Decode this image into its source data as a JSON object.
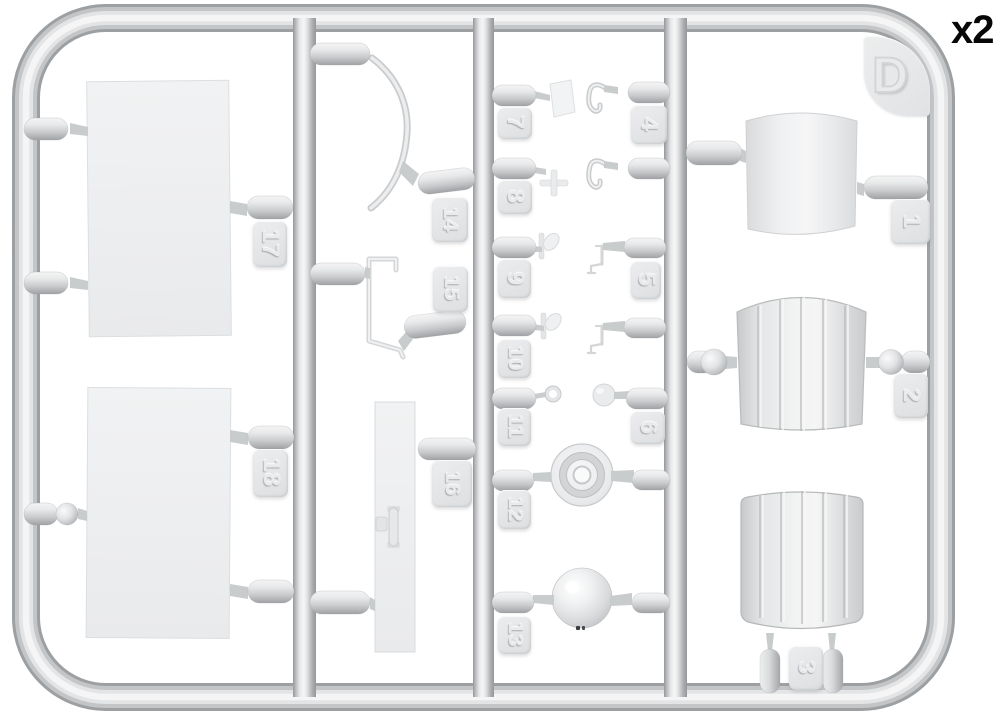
{
  "sprue": {
    "letter": "D",
    "quantity_label": "x2",
    "part_tags": {
      "p1": "1",
      "p2": "2",
      "p3": "3",
      "p4": "4",
      "p5": "5",
      "p6": "6",
      "p7": "7",
      "p8": "8",
      "p9": "9",
      "p10": "10",
      "p11": "11",
      "p12": "12",
      "p13": "13",
      "p14": "14",
      "p15": "15",
      "p16": "16",
      "p17": "17",
      "p18": "18"
    },
    "colors": {
      "plastic_light": "#f4f4f5",
      "plastic_mid": "#d9dbdd",
      "plastic_dark": "#9fa1a4",
      "background": "#ffffff",
      "label_text": "#070707"
    }
  }
}
